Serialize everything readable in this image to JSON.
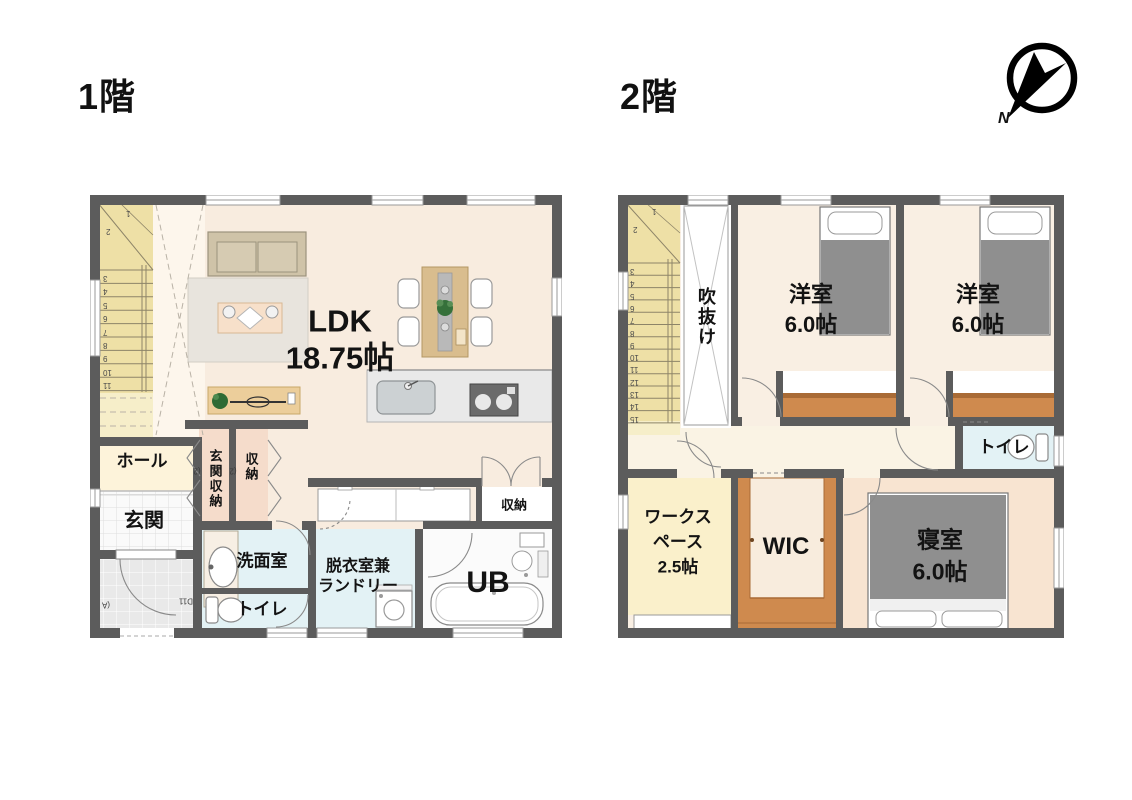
{
  "compass": {
    "north_label": "N"
  },
  "floor1": {
    "title": "1階",
    "labels": {
      "ldk_name": "LDK",
      "ldk_size": "18.75帖",
      "hall": "ホール",
      "entrance": "玄関",
      "entrance_storage": "玄関収納",
      "closet": "収納",
      "washroom": "洗面室",
      "toilet": "トイレ",
      "laundry_line1": "脱衣室兼",
      "laundry_line2": "ランドリー",
      "unit_bath": "UB",
      "closet_right": "収納",
      "door_code_entrance": "D11",
      "door_code_closet_a": "(2",
      "door_code_closet_b": "(2",
      "door_code_porch": "(A"
    },
    "stair_numbers": [
      "1",
      "2",
      "3",
      "4",
      "5",
      "6",
      "7",
      "8",
      "9",
      "10",
      "11"
    ]
  },
  "floor2": {
    "title": "2階",
    "labels": {
      "void": "吹抜け",
      "western1_name": "洋室",
      "western1_size": "6.0帖",
      "western2_name": "洋室",
      "western2_size": "6.0帖",
      "toilet": "トイレ",
      "workspace_line1": "ワークス",
      "workspace_line2": "ペース",
      "workspace_size": "2.5帖",
      "wic": "WIC",
      "master_name": "寝室",
      "master_size": "6.0帖"
    },
    "stair_numbers": [
      "1",
      "2",
      "3",
      "4",
      "5",
      "6",
      "7",
      "8",
      "9",
      "10",
      "11",
      "12",
      "13",
      "14",
      "15"
    ]
  },
  "colors": {
    "wall": "#5c5c5c",
    "ldk_floor": "#f8ecdf",
    "stair_floor": "#eee0a6",
    "hall_floor": "#fdf3da",
    "wet_room_floor": "#e3f2f5",
    "closet_pink": "#f5dccb",
    "closet_orange": "#cf8a4e",
    "workspace_floor": "#faf0cb",
    "master_floor": "#f8e4d1",
    "bed_gray": "#8f8f8f",
    "sofa_tan": "#cfc3a8",
    "table_wood": "#d9bd8e"
  }
}
